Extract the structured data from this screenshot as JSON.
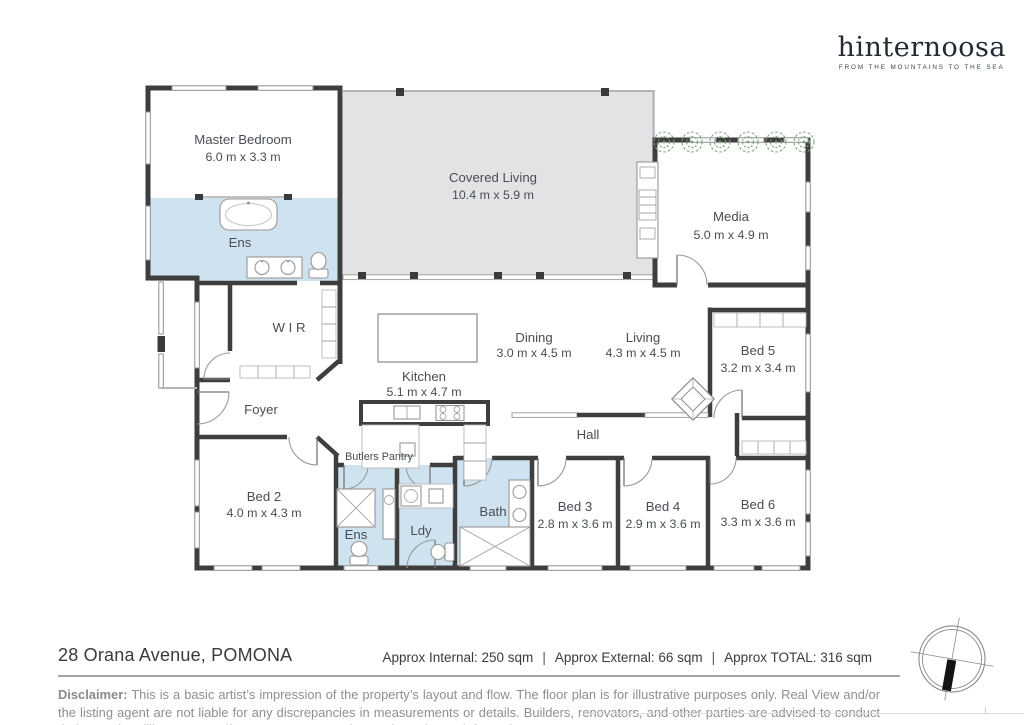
{
  "brand": {
    "name": "hinternoosa",
    "tagline": "FROM THE MOUNTAINS TO THE SEA"
  },
  "rooms": {
    "master": {
      "name": "Master Bedroom",
      "dims": "6.0 m x 3.3 m"
    },
    "ens1": {
      "name": "Ens"
    },
    "covered": {
      "name": "Covered Living",
      "dims": "10.4 m x 5.9 m"
    },
    "media": {
      "name": "Media",
      "dims": "5.0 m x 4.9 m"
    },
    "wir": {
      "name": "W I R"
    },
    "dining": {
      "name": "Dining",
      "dims": "3.0 m x 4.5 m"
    },
    "living": {
      "name": "Living",
      "dims": "4.3 m x 4.5 m"
    },
    "kitchen": {
      "name": "Kitchen",
      "dims": "5.1 m x 4.7 m"
    },
    "bed5": {
      "name": "Bed 5",
      "dims": "3.2 m x 3.4 m"
    },
    "foyer": {
      "name": "Foyer"
    },
    "hall": {
      "name": "Hall"
    },
    "butlers": {
      "name": "Butlers Pantry"
    },
    "bed2": {
      "name": "Bed 2",
      "dims": "4.0 m x 4.3 m"
    },
    "ens2": {
      "name": "Ens"
    },
    "ldy": {
      "name": "Ldy"
    },
    "bath": {
      "name": "Bath"
    },
    "bed3": {
      "name": "Bed 3",
      "dims": "2.8 m x 3.6 m"
    },
    "bed4": {
      "name": "Bed 4",
      "dims": "2.9 m x 3.6 m"
    },
    "bed6": {
      "name": "Bed 6",
      "dims": "3.3 m x 3.6 m"
    }
  },
  "footer": {
    "address": "28 Orana Avenue, POMONA",
    "stats": {
      "internal": "Approx Internal: 250 sqm",
      "external": "Approx External: 66 sqm",
      "total": "Approx TOTAL: 316 sqm",
      "separator": "|"
    },
    "disclaimer_label": "Disclaimer:",
    "disclaimer_text": "This is a basic artist’s impression of the property’s layout and flow. The floor plan is for illustrative purposes only. Real View and/or the listing agent are not liable for any discrepancies in measurements or details. Builders, renovators, and other parties are advised to conduct their own due diligence to verify measurements and any other relevant information."
  },
  "colors": {
    "wet_area": "#cfe2ef",
    "covered_area": "#e3e3e5",
    "wall": "#3e3e3e",
    "label_text": "#484e53",
    "plant_green": "#79a279"
  }
}
